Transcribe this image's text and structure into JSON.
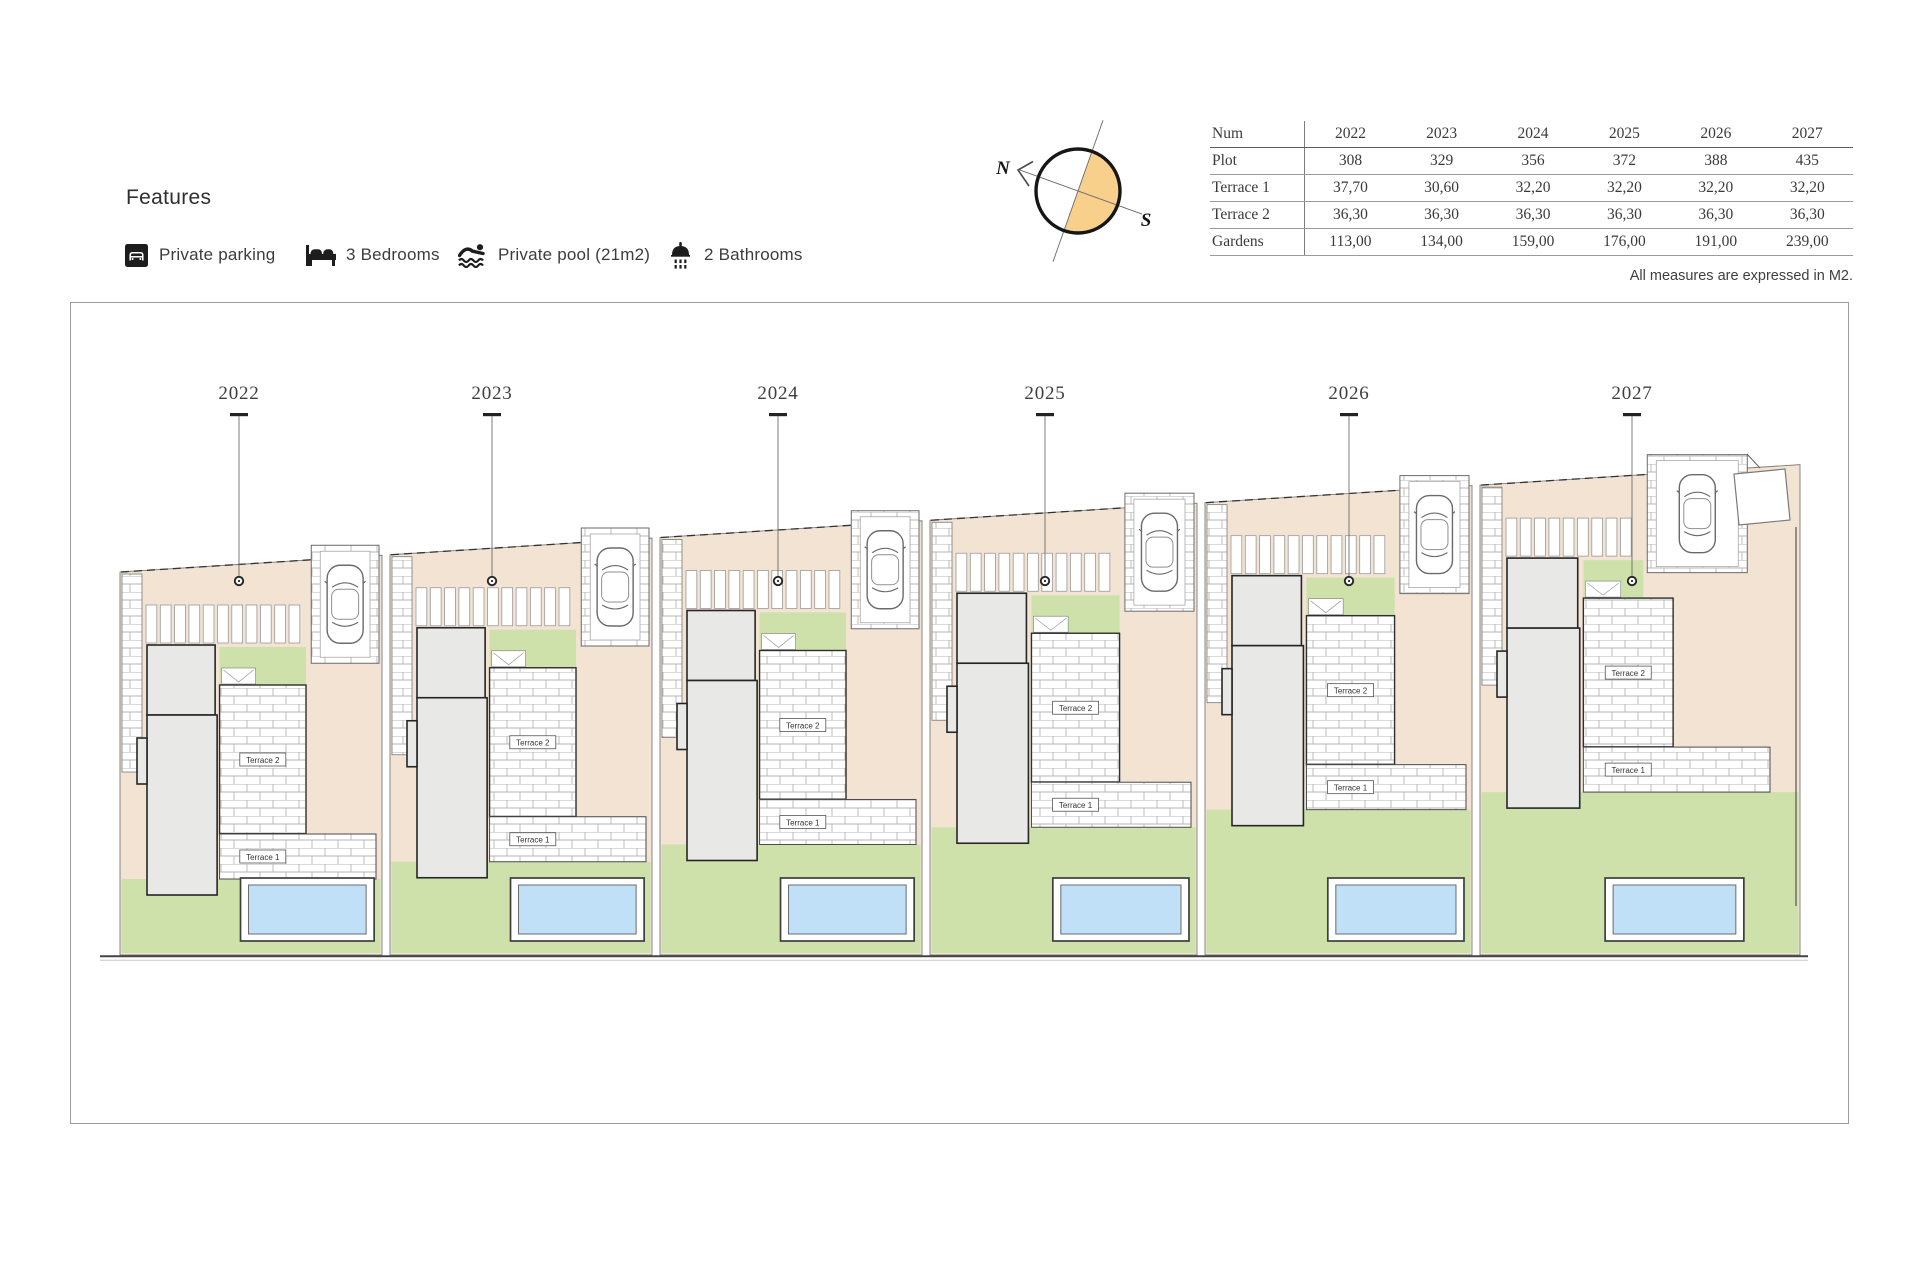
{
  "features": {
    "title": "Features",
    "items": [
      {
        "icon": "parking-icon",
        "label": "Private parking"
      },
      {
        "icon": "bed-icon",
        "label": "3 Bedrooms"
      },
      {
        "icon": "swimmer-icon",
        "label": "Private pool (21m2)"
      },
      {
        "icon": "shower-icon",
        "label": "2 Bathrooms"
      }
    ]
  },
  "compass": {
    "north": "N",
    "south": "S"
  },
  "table": {
    "header": [
      "Num",
      "2022",
      "2023",
      "2024",
      "2025",
      "2026",
      "2027"
    ],
    "rows": [
      [
        "Plot",
        "308",
        "329",
        "356",
        "372",
        "388",
        "435"
      ],
      [
        "Terrace 1",
        "37,70",
        "30,60",
        "32,20",
        "32,20",
        "32,20",
        "32,20"
      ],
      [
        "Terrace 2",
        "36,30",
        "36,30",
        "36,30",
        "36,30",
        "36,30",
        "36,30"
      ],
      [
        "Gardens",
        "113,00",
        "134,00",
        "159,00",
        "176,00",
        "191,00",
        "239,00"
      ]
    ],
    "note": "All measures are expressed in M2."
  },
  "plan": {
    "terrace1_label": "Terrace 1",
    "terrace2_label": "Terrace 2",
    "plots": [
      {
        "label": "2022"
      },
      {
        "label": "2023"
      },
      {
        "label": "2024"
      },
      {
        "label": "2025"
      },
      {
        "label": "2026"
      },
      {
        "label": "2027"
      }
    ]
  },
  "colors": {
    "beige": "#f2e3d2",
    "green": "#cee1aa",
    "pool_water": "#bfe0f6",
    "house_grey": "#e8e8e6",
    "compass_orange": "#f8cf8b",
    "brick_line": "#b5b5b5",
    "ink": "#3a3a3a"
  }
}
